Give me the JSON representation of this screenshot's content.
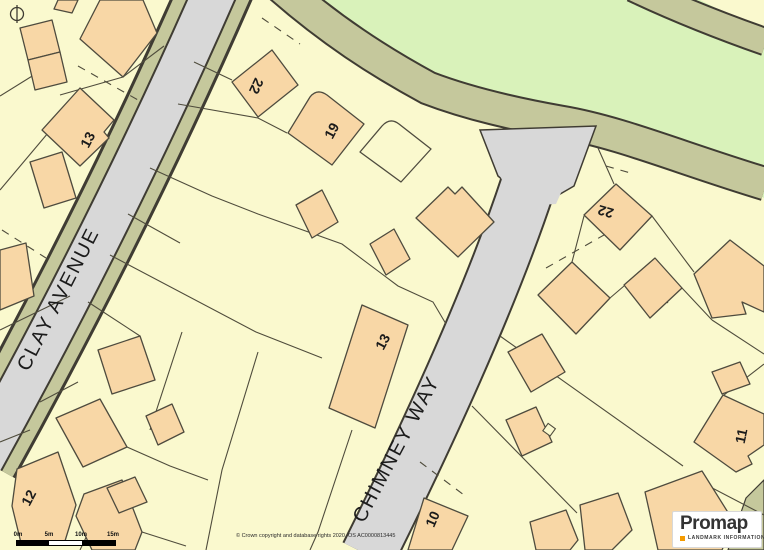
{
  "map": {
    "street_labels": [
      {
        "text": "CLAY AVENUE"
      },
      {
        "text": "CHIMNEY WAY"
      }
    ],
    "house_numbers": [
      "13",
      "22",
      "19",
      "13",
      "22",
      "12",
      "11",
      "10"
    ],
    "colors": {
      "background": "#FAF9CE",
      "building": "#F8D7A6",
      "road": "#D8D8D8",
      "verge": "#C5C89C",
      "greenspace": "#D9F2BA",
      "outline": "#45432F"
    }
  },
  "scale_bar": {
    "labels": [
      "0m",
      "5m",
      "10m",
      "15m"
    ]
  },
  "attribution": {
    "text": "© Crown copyright and database rights 2020. OS AC0000813445"
  },
  "logo": {
    "brand": "Promap",
    "tagline": "LANDMARK INFORMATION",
    "accent_color": "#F59B00"
  }
}
